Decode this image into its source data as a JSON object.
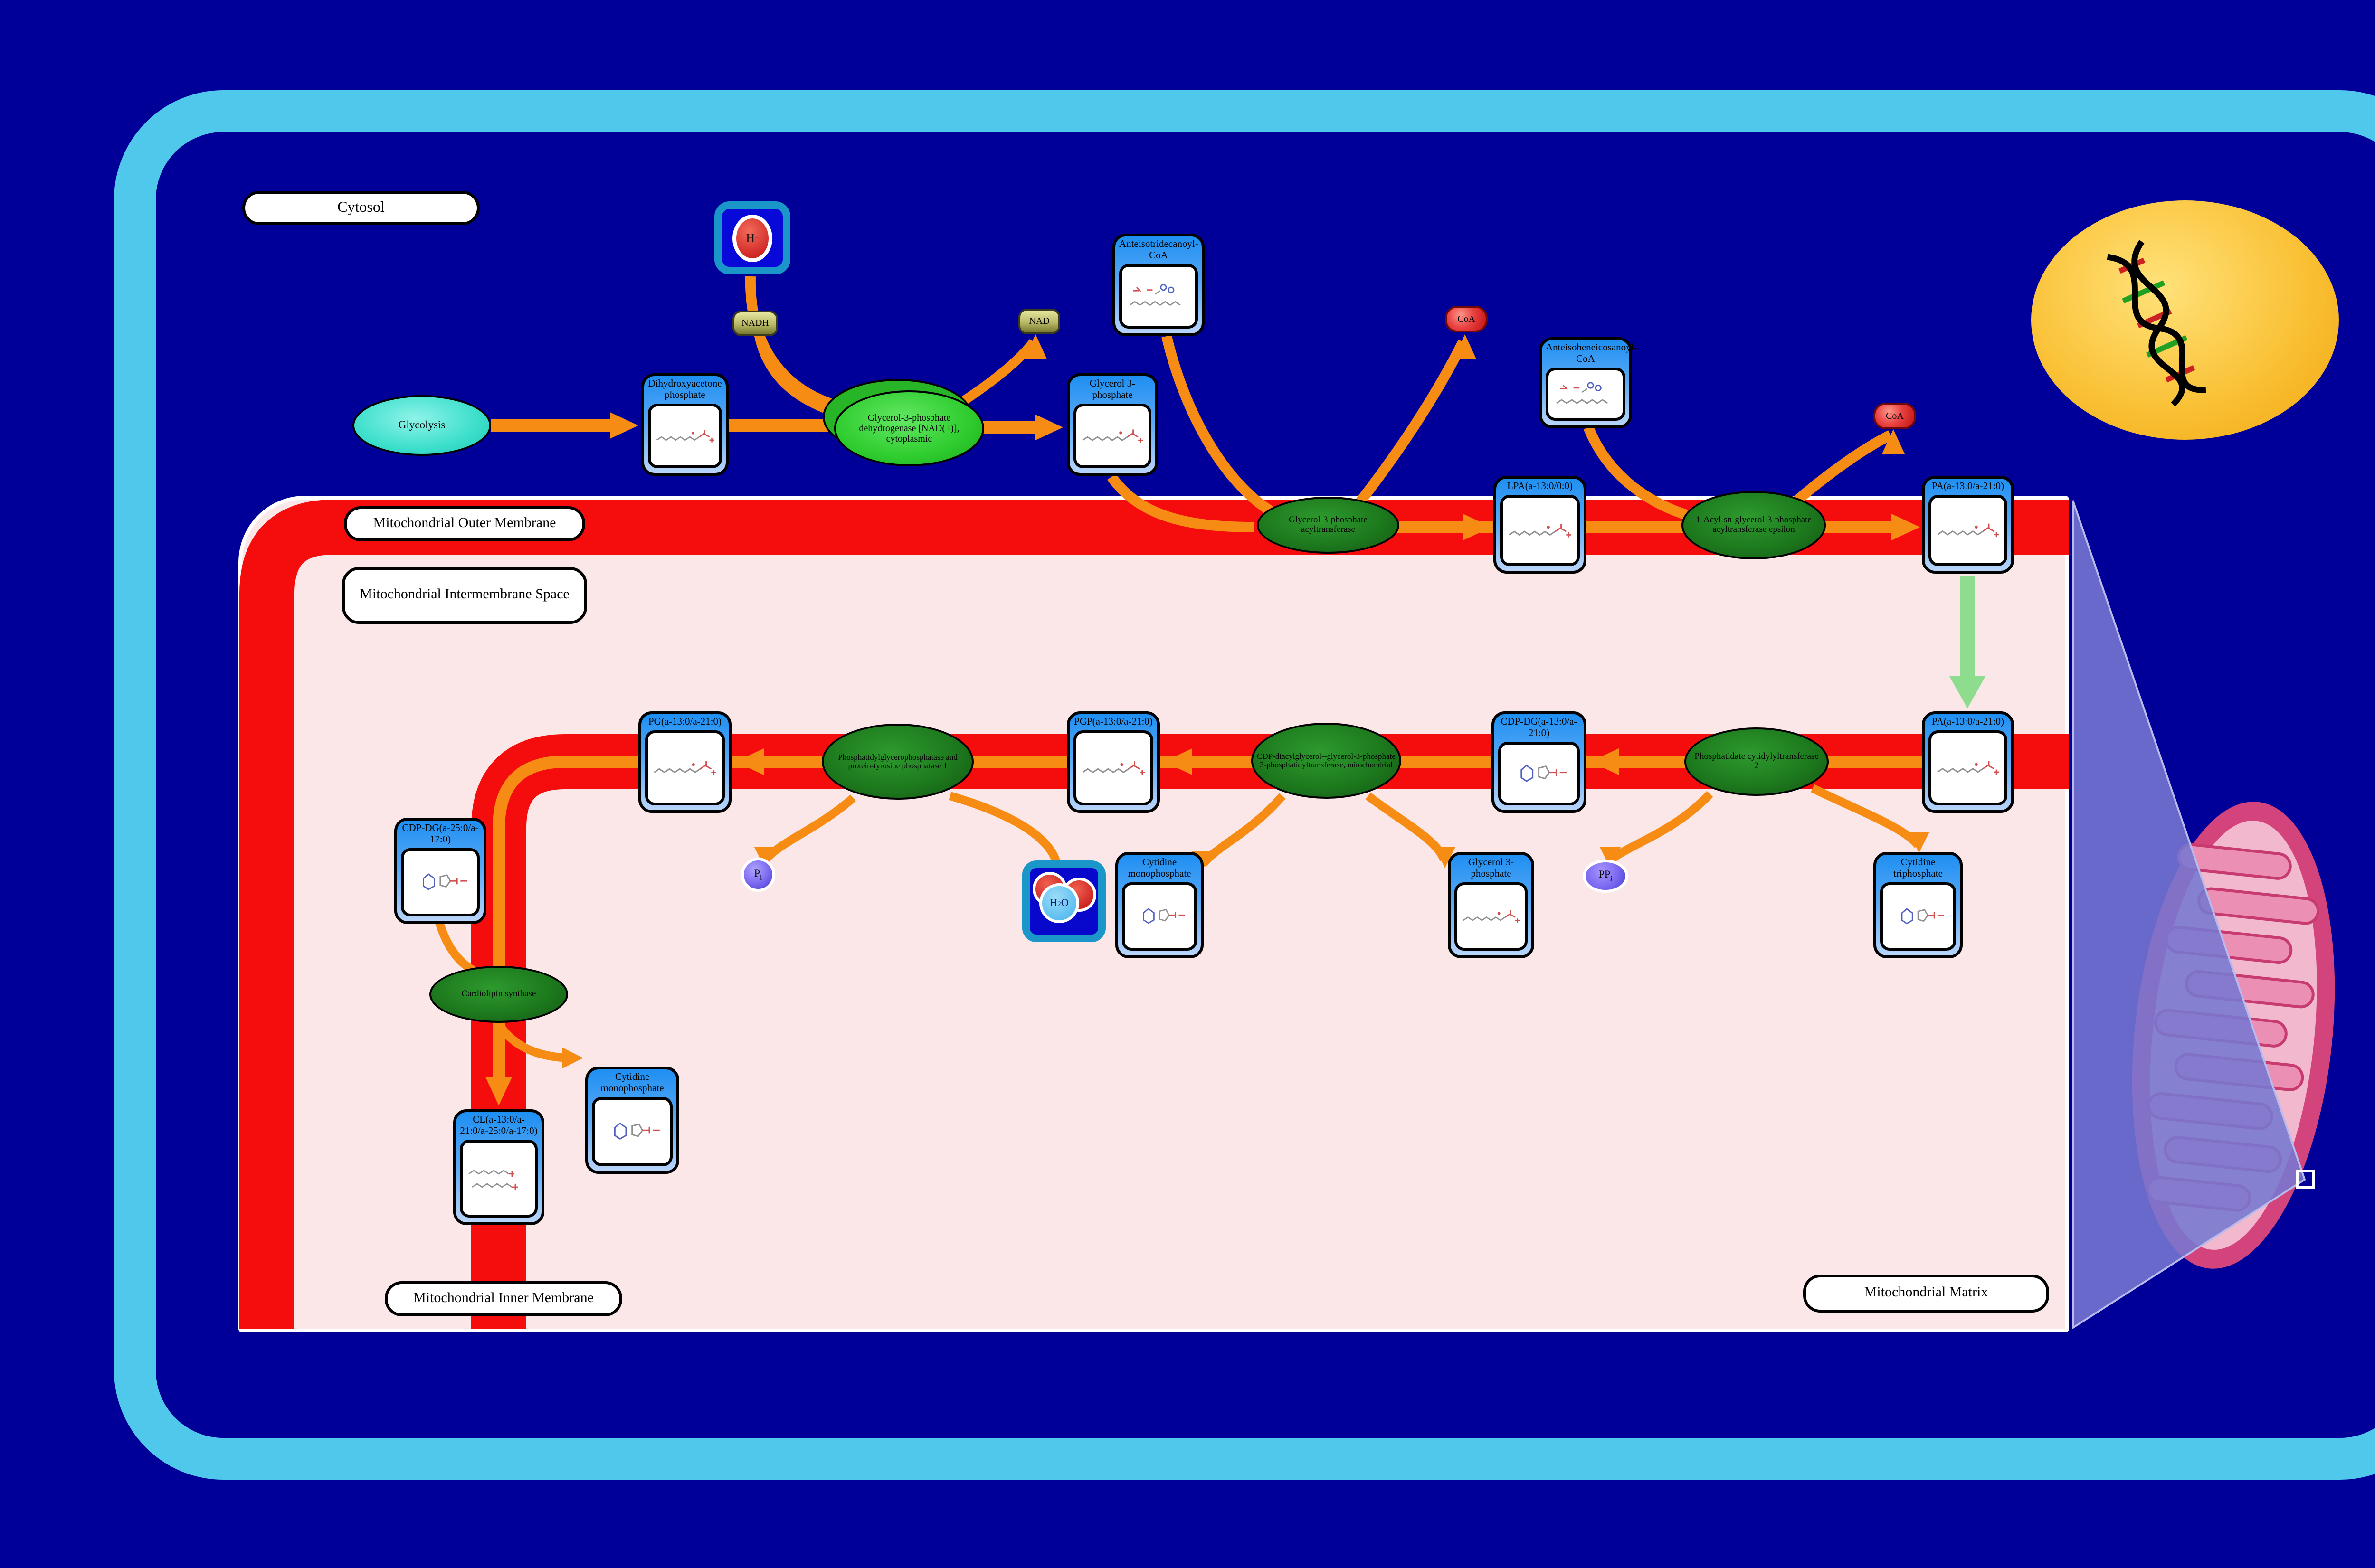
{
  "regions": {
    "cytosol": "Cytosol",
    "outer_membrane": "Mitochondrial Outer Membrane",
    "intermembrane_space": "Mitochondrial Intermembrane Space",
    "inner_membrane": "Mitochondrial Inner Membrane",
    "matrix": "Mitochondrial Matrix"
  },
  "process": {
    "glycolysis": "Glycolysis"
  },
  "enzymes": {
    "gpd_cytoplasmic": "Glycerol-3-phosphate dehydrogenase [NAD(+)], cytoplasmic",
    "gpat": "Glycerol-3-phosphate acyltransferase",
    "agpat_epsilon": "1-Acyl-sn-glycerol-3-phosphate acyltransferase epsilon",
    "pcyt2": "Phosphatidate cytidylyltransferase 2",
    "pgs_mito": "CDP-diacylglycerol--glycerol-3-phosphate 3-phosphatidyltransferase, mitochondrial",
    "ptpmt1": "Phosphatidylglycerophosphatase and protein-tyrosine phosphatase 1",
    "cardiolipin_synthase": "Cardiolipin synthase"
  },
  "metabolites": {
    "dhap": "Dihydroxyacetone phosphate",
    "glycerol_3_phosphate_cytosol": "Glycerol 3-phosphate",
    "anteisotridecanoyl_coa": "Anteisotridecanoyl-CoA",
    "lpa": "LPA(a-13:0/0:0)",
    "anteisoheneicosanoyl_coa": "Anteisoheneicosanoyl-CoA",
    "pa_outer": "PA(a-13:0/a-21:0)",
    "pa_inner": "PA(a-13:0/a-21:0)",
    "cdp_dg_13_21": "CDP-DG(a-13:0/a-21:0)",
    "pgp": "PGP(a-13:0/a-21:0)",
    "pg": "PG(a-13:0/a-21:0)",
    "cdp_dg_25_17": "CDP-DG(a-25:0/a-17:0)",
    "cl": "CL(a-13:0/a-21:0/a-25:0/a-17:0)",
    "cmp_left": "Cytidine monophosphate",
    "cmp_middle": "Cytidine monophosphate",
    "glycerol_3_phosphate_matrix": "Glycerol 3-phosphate",
    "ctp": "Cytidine triphosphate"
  },
  "small_molecules": {
    "nadh": "NADH",
    "nad": "NAD",
    "h_plus": {
      "base": "H",
      "sup": "+"
    },
    "coa_1": "CoA",
    "coa_2": "CoA",
    "pi": {
      "base": "P",
      "sub": "i"
    },
    "ppi": {
      "base": "PP",
      "sub": "i"
    },
    "h2o": {
      "h": "H",
      "two": "2",
      "o": "O"
    }
  },
  "colors": {
    "background": "#000099",
    "cell_border": "#50C8EC",
    "membrane_red": "#F50D0D",
    "arrow_orange": "#F78C14",
    "transport_arrow_green": "#8EDC8E",
    "metabolite_node_blue": "#1E8FF2",
    "enzyme_green_dark": "#1D7A1D",
    "enzyme_green_bright": "#33CC33",
    "process_teal": "#35E0D0",
    "intermembrane_pink": "#FBE7E7",
    "nucleus_yellow": "#F6B51E",
    "mitochondrion_pink": "#D81B60",
    "projection_purple": "#7678D2"
  }
}
